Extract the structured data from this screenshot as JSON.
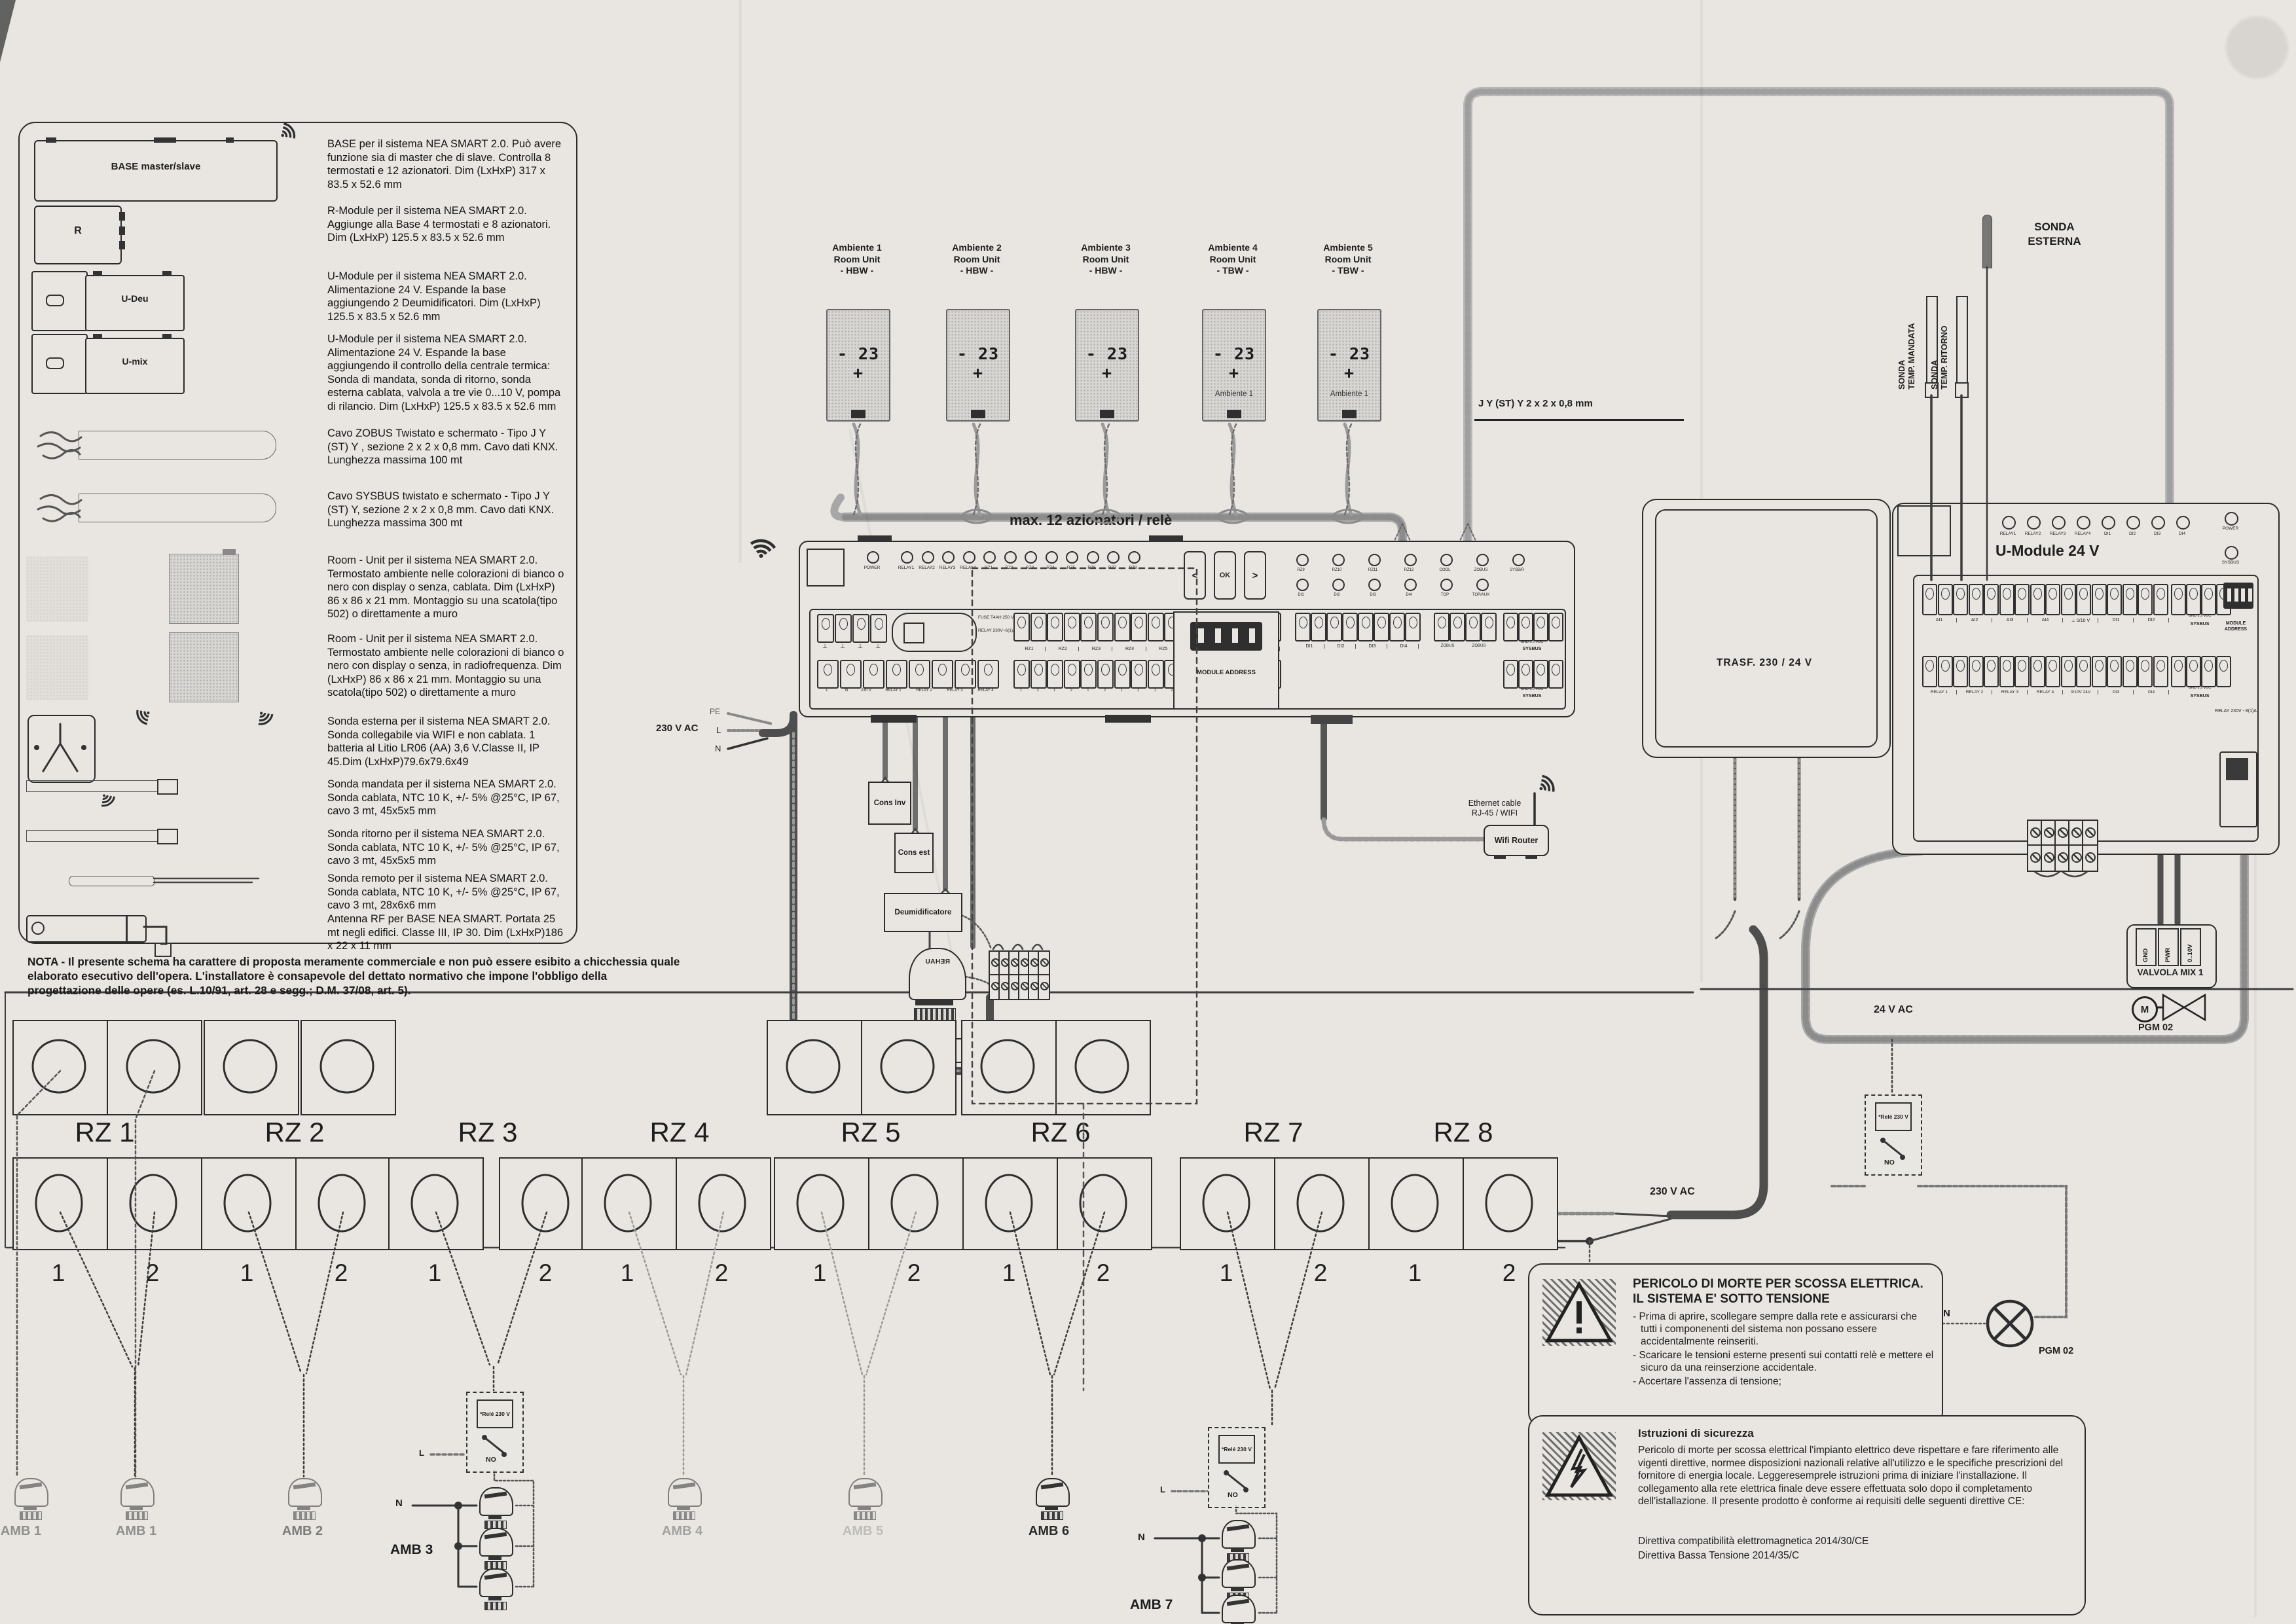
{
  "colors": {
    "paper": "#e9e6e1",
    "ink": "#1e1e1e",
    "bus_gray": "#a8a8a8",
    "bus_light": "#b6b6b6",
    "wire_dark": "#4e4e4e"
  },
  "legend": {
    "items": [
      {
        "icon": "base-module",
        "label": "BASE  master/slave",
        "desc": "BASE per il sistema NEA SMART 2.0. Può avere funzione sia di master che di slave. Controlla 8 termostati e 12 azionatori. Dim (LxHxP) 317 x 83.5 x 52.6 mm"
      },
      {
        "icon": "r-module",
        "label": "R",
        "desc": "R-Module per il sistema NEA SMART 2.0. Aggiunge alla Base 4 termostati e 8 azionatori. Dim (LxHxP) 125.5 x 83.5 x 52.6 mm"
      },
      {
        "icon": "u-module-deu",
        "label": "U-Deu",
        "desc": "U-Module per il sistema NEA SMART 2.0. Alimentazione 24 V. Espande la base aggiungendo 2 Deumidificatori. Dim (LxHxP) 125.5 x 83.5 x 52.6 mm"
      },
      {
        "icon": "u-module-mix",
        "label": "U-mix",
        "desc": "U-Module per il sistema NEA SMART 2.0. Alimentazione 24 V. Espande la base aggiungendo il controllo della centrale termica: Sonda di mandata, sonda di ritorno, sonda esterna cablata, valvola a tre vie 0...10 V, pompa di rilancio. Dim (LxHxP) 125.5 x 83.5 x 52.6 mm"
      },
      {
        "icon": "cable",
        "label": "",
        "desc": "Cavo  ZOBUS  Twistato e schermato   -   Tipo J Y (ST) Y , sezione 2 x 2 x 0,8 mm. Cavo dati KNX. Lunghezza massima 100 mt"
      },
      {
        "icon": "cable",
        "label": "",
        "desc": "Cavo SYSBUS  twistato e schermato   -   Tipo J Y (ST) Y, sezione 2 x 2 x 0,8 mm. Cavo dati KNX. Lunghezza massima 300 mt"
      },
      {
        "icon": "room-unit",
        "label": "",
        "desc": "Room - Unit per il sistema NEA SMART 2.0. Termostato ambiente nelle colorazioni di bianco o nero con display o senza, cablata. Dim (LxHxP) 86 x 86 x 21 mm. Montaggio su una scatola(tipo 502) o direttamente a muro"
      },
      {
        "icon": "room-unit-rf",
        "label": "",
        "desc": "Room - Unit per il sistema NEA SMART 2.0. Termostato ambiente nelle colorazioni di bianco o nero con display o senza, in radiofrequenza. Dim (LxHxP) 86 x 86 x 21 mm. Montaggio su una scatola(tipo 502) o direttamente a muro"
      },
      {
        "icon": "sonda-esterna",
        "label": "",
        "desc": "Sonda esterna per il sistema NEA SMART 2.0. Sonda collegabile via WIFI e non cablata. 1 batteria al Litio LR06 (AA) 3,6 V.Classe II, IP 45.Dim (LxHxP)79.6x79.6x49"
      },
      {
        "icon": "sonda-probe",
        "label": "",
        "desc": "Sonda mandata per il sistema NEA SMART 2.0. Sonda cablata, NTC 10 K, +/- 5% @25°C, IP 67, cavo 3 mt, 45x5x5 mm"
      },
      {
        "icon": "sonda-probe",
        "label": "",
        "desc": "Sonda ritorno per il sistema NEA SMART 2.0. Sonda cablata, NTC 10 K, +/- 5% @25°C, IP 67, cavo 3 mt, 45x5x5 mm"
      },
      {
        "icon": "sonda-remoto",
        "label": "",
        "desc": "Sonda remoto per il sistema NEA SMART 2.0. Sonda cablata, NTC 10 K, +/- 5% @25°C, IP 67, cavo 3 mt, 28x6x6 mm"
      },
      {
        "icon": "antenna",
        "label": "",
        "desc": "Antenna RF per BASE NEA SMART. Portata 25 mt negli edifici. Classe III, IP 30. Dim (LxHxP)186 x 22 x 11 mm"
      }
    ],
    "note": "NOTA - Il presente schema ha carattere di proposta meramente commerciale e non può essere esibito a chicchessia quale elaborato esecutivo dell'opera. L'installatore è consapevole del dettato normativo che impone l'obbligo della progettazione delle opere (es. L.10/91, art. 28 e segg.; D.M. 37/08, art. 5)."
  },
  "room_units": [
    {
      "line1": "Ambiente 1",
      "line2": "Room Unit",
      "line3": "- HBW -",
      "display": "- 23 +",
      "sub": ""
    },
    {
      "line1": "Ambiente 2",
      "line2": "Room Unit",
      "line3": "- HBW -",
      "display": "- 23 +",
      "sub": ""
    },
    {
      "line1": "Ambiente 3",
      "line2": "Room Unit",
      "line3": "- HBW -",
      "display": "- 23 +",
      "sub": ""
    },
    {
      "line1": "Ambiente 4",
      "line2": "Room Unit",
      "line3": "- TBW -",
      "display": "- 23 +",
      "sub": "Ambiente 1"
    },
    {
      "line1": "Ambiente 5",
      "line2": "Room Unit",
      "line3": "- TBW -",
      "display": "- 23 +",
      "sub": "Ambiente 1"
    }
  ],
  "cable_label": "J Y (ST) Y  2 x 2 x 0,8 mm",
  "base": {
    "title": "max. 12 azionatori / relè",
    "leds_main": [
      "POWER",
      "RELAY1",
      "RELAY2",
      "RELAY3",
      "RELAY4",
      "RZ1",
      "RZ2",
      "RZ3",
      "RZ4",
      "RZ5",
      "RZ6",
      "RZ7",
      "RZ8"
    ],
    "buttons": [
      "<",
      "OK",
      ">"
    ],
    "leds_right_row1": [
      "RZ9",
      "RZ10",
      "RZ11",
      "RZ12",
      "COOL",
      "ZOBUS",
      "SYSB/R"
    ],
    "leds_right_row2": [
      "DI1",
      "DI2",
      "DI3",
      "DI4",
      "TOP",
      "TOP/AUX"
    ],
    "rz_terminals": [
      "RZ1",
      "RZ2",
      "RZ3",
      "RZ4",
      "RZ5",
      "RZ6",
      "RZ7",
      "RZ8"
    ],
    "di_terminals": [
      "DI1",
      "DI2",
      "DI3",
      "DI4"
    ],
    "zobus_terminals": [
      "ZOBUS",
      "ZOBUS"
    ],
    "sysbus_pins": "GND  1  2  VDC",
    "sysbus_label": "SYSBUS",
    "module_address": "MODULE ADDRESS",
    "fuse_text": "FUSE T4AH 250 V",
    "relay_text": "RELAY 230V~6(1)A",
    "power_terms": [
      "L",
      "N",
      "230 V"
    ],
    "relay_terms": [
      "RELAY 1",
      "RELAY 2",
      "RELAY 3",
      "RELAY 4"
    ]
  },
  "supply": {
    "v230_left": "230 V AC",
    "pe": "PE",
    "l": "L",
    "n": "N",
    "v230_right": "230 V AC",
    "v24": "24 V AC"
  },
  "cons": {
    "inv": "Cons Inv",
    "est": "Cons est",
    "deumid": "Deumidificatore",
    "valvola": "Valvola",
    "rehau": "REHAU"
  },
  "router": {
    "cable1": "Ethernet cable",
    "cable2": "RJ-45  /  WIFI",
    "label": "Wifi Router"
  },
  "trasf": {
    "label": "TRASF.  230 / 24  V"
  },
  "sonde": {
    "mandata1": "SONDA",
    "mandata2": "TEMP. MANDATA",
    "ritorno1": "SONDA",
    "ritorno2": "TEMP. RITORNO",
    "esterna1": "SONDA",
    "esterna2": "ESTERNA"
  },
  "u_module": {
    "title": "U-Module 24 V",
    "leds": [
      "RELAY1",
      "RELAY2",
      "RELAY3",
      "RELAY4",
      "DI1",
      "DI2",
      "DI3",
      "DI4"
    ],
    "led_power": "POWER",
    "led_sysbus": "SYSBUS",
    "row1": [
      "AI1",
      "AI2",
      "AI3",
      "AI4",
      "⊥ 0/10 V",
      "DI1",
      "DI2"
    ],
    "row1_sysbus_pins": "GND 1 2 VDC",
    "row1_sysbus": "SYSBUS",
    "row2": [
      "RELAY 1",
      "RELAY 2",
      "RELAY 3",
      "RELAY 4",
      "0/10V 24V",
      "DI3",
      "DI4"
    ],
    "row2_sysbus_pins": "GND 1 2 VDC",
    "row2_sysbus": "SYSBUS",
    "module_address": "MODULE ADDRESS",
    "relay_note": "RELAY 230V - 8(1)A"
  },
  "rele": {
    "title": "*Relé 230 V",
    "no": "NO",
    "l": "L"
  },
  "valvola_mix": {
    "title": "VALVOLA MIX 1",
    "terms": [
      "GND",
      "PWR",
      "0..10V"
    ],
    "motor": "M",
    "pgm": "PGM 02"
  },
  "pump": {
    "n": "N",
    "pgm": "PGM 02"
  },
  "zones": {
    "labels": [
      "RZ 1",
      "RZ 2",
      "RZ 3",
      "RZ 4",
      "RZ 5",
      "RZ 6",
      "RZ 7",
      "RZ 8"
    ],
    "numbers": [
      "1",
      "2"
    ],
    "amb_single": [
      {
        "label": "AMB 1",
        "clip": true,
        "faint": true
      },
      {
        "label": "AMB 1",
        "clip": false,
        "faint": true
      },
      {
        "label": "AMB 2",
        "clip": false,
        "faint": true
      },
      {
        "label": "AMB 4",
        "clip": false,
        "faint": true
      },
      {
        "label": "AMB 5",
        "clip": false,
        "faint": true
      },
      {
        "label": "AMB 6",
        "clip": false,
        "faint": false
      }
    ],
    "amb_group1": "AMB 3",
    "amb_group2": "AMB 7"
  },
  "warning1": {
    "title": "PERICOLO DI MORTE PER SCOSSA ELETTRICA. IL SISTEMA E' SOTTO TENSIONE",
    "bullets": [
      "- Prima di aprire, scollegare sempre dalla rete e assicurarsi che tutti i componenenti del sistema non possano essere accidentalmente reinseriti.",
      "- Scaricare le tensioni esterne presenti sui contatti relè e mettere el sicuro da una reinserzione accidentale.",
      "- Accertare l'assenza di tensione;"
    ]
  },
  "warning2": {
    "title": "Istruzioni di sicurezza",
    "body": "Pericolo di morte per scossa elettrical l'impianto elettrico deve rispettare e fare riferimento alle vigenti direttive, normee disposizioni nazionali relative all'utilizzo e le specifiche prescrizioni del fornitore di energia locale. Leggeresemprele istruzioni prima di iniziare l'installazione. Il collegamento alla rete elettrica finale deve essere effettuata solo dopo il completamento dell'istallazione. Il presente prodotto è conforme ai requisiti delle seguenti direttive CE:",
    "d1": "Direttiva compatibilità elettromagnetica 2014/30/CE",
    "d2": "Direttiva Bassa Tensione  2014/35/C"
  }
}
